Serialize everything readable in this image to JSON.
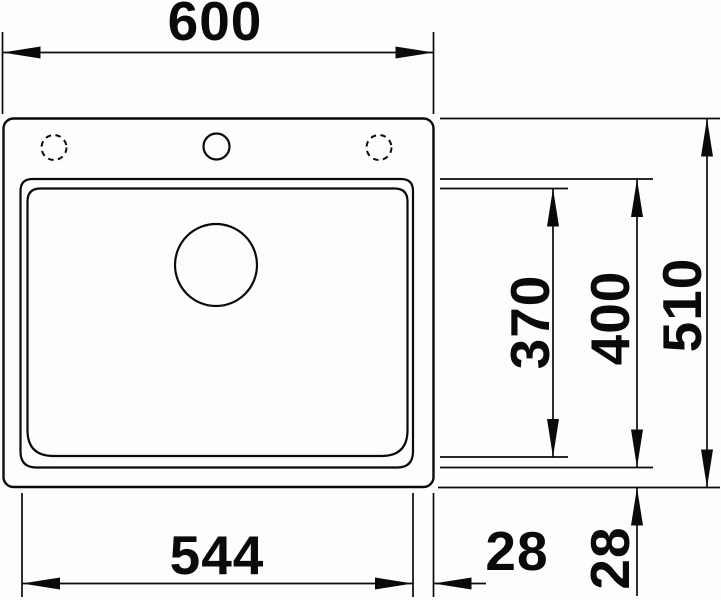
{
  "meta": {
    "type": "technical-dimension-drawing",
    "subject": "inset kitchen sink, top view",
    "background_color": "#fdfdfd",
    "line_color": "#0a0a0a",
    "unit": "mm"
  },
  "labels": {
    "overall_width": "600",
    "overall_depth": "510",
    "bowl_outer_depth": "400",
    "bowl_inner_depth": "370",
    "bowl_width": "544",
    "side_offset": "28",
    "bottom_offset": "28"
  },
  "dimensions": [
    {
      "id": "overall-width",
      "value": 600,
      "orientation": "horizontal",
      "position": "top",
      "measures": "outer sink width"
    },
    {
      "id": "overall-depth",
      "value": 510,
      "orientation": "vertical",
      "position": "right-outer",
      "measures": "outer sink depth"
    },
    {
      "id": "bowl-outer-depth",
      "value": 400,
      "orientation": "vertical",
      "position": "right-middle",
      "measures": "bowl outer contour depth"
    },
    {
      "id": "bowl-inner-depth",
      "value": 370,
      "orientation": "vertical",
      "position": "right-inner",
      "measures": "bowl inner contour depth"
    },
    {
      "id": "bowl-width",
      "value": 544,
      "orientation": "horizontal",
      "position": "bottom",
      "measures": "bowl outer contour width"
    },
    {
      "id": "side-offset",
      "value": 28,
      "orientation": "horizontal",
      "position": "bottom-right",
      "measures": "gap bowl edge to sink edge"
    },
    {
      "id": "bottom-offset",
      "value": 28,
      "orientation": "vertical",
      "position": "bottom-right",
      "measures": "gap bowl edge to sink edge"
    }
  ],
  "features": [
    {
      "id": "sink-outline",
      "shape": "rounded-rectangle",
      "style": "solid"
    },
    {
      "id": "bowl-outer-edge",
      "shape": "rounded-rectangle",
      "style": "solid"
    },
    {
      "id": "bowl-inner-edge",
      "shape": "rounded-rectangle",
      "style": "solid"
    },
    {
      "id": "drain-hole",
      "shape": "circle",
      "style": "solid"
    },
    {
      "id": "tap-hole-center",
      "shape": "circle",
      "style": "solid"
    },
    {
      "id": "tap-hole-left-option",
      "shape": "circle",
      "style": "dashed"
    },
    {
      "id": "tap-hole-right-option",
      "shape": "circle",
      "style": "dashed"
    }
  ]
}
